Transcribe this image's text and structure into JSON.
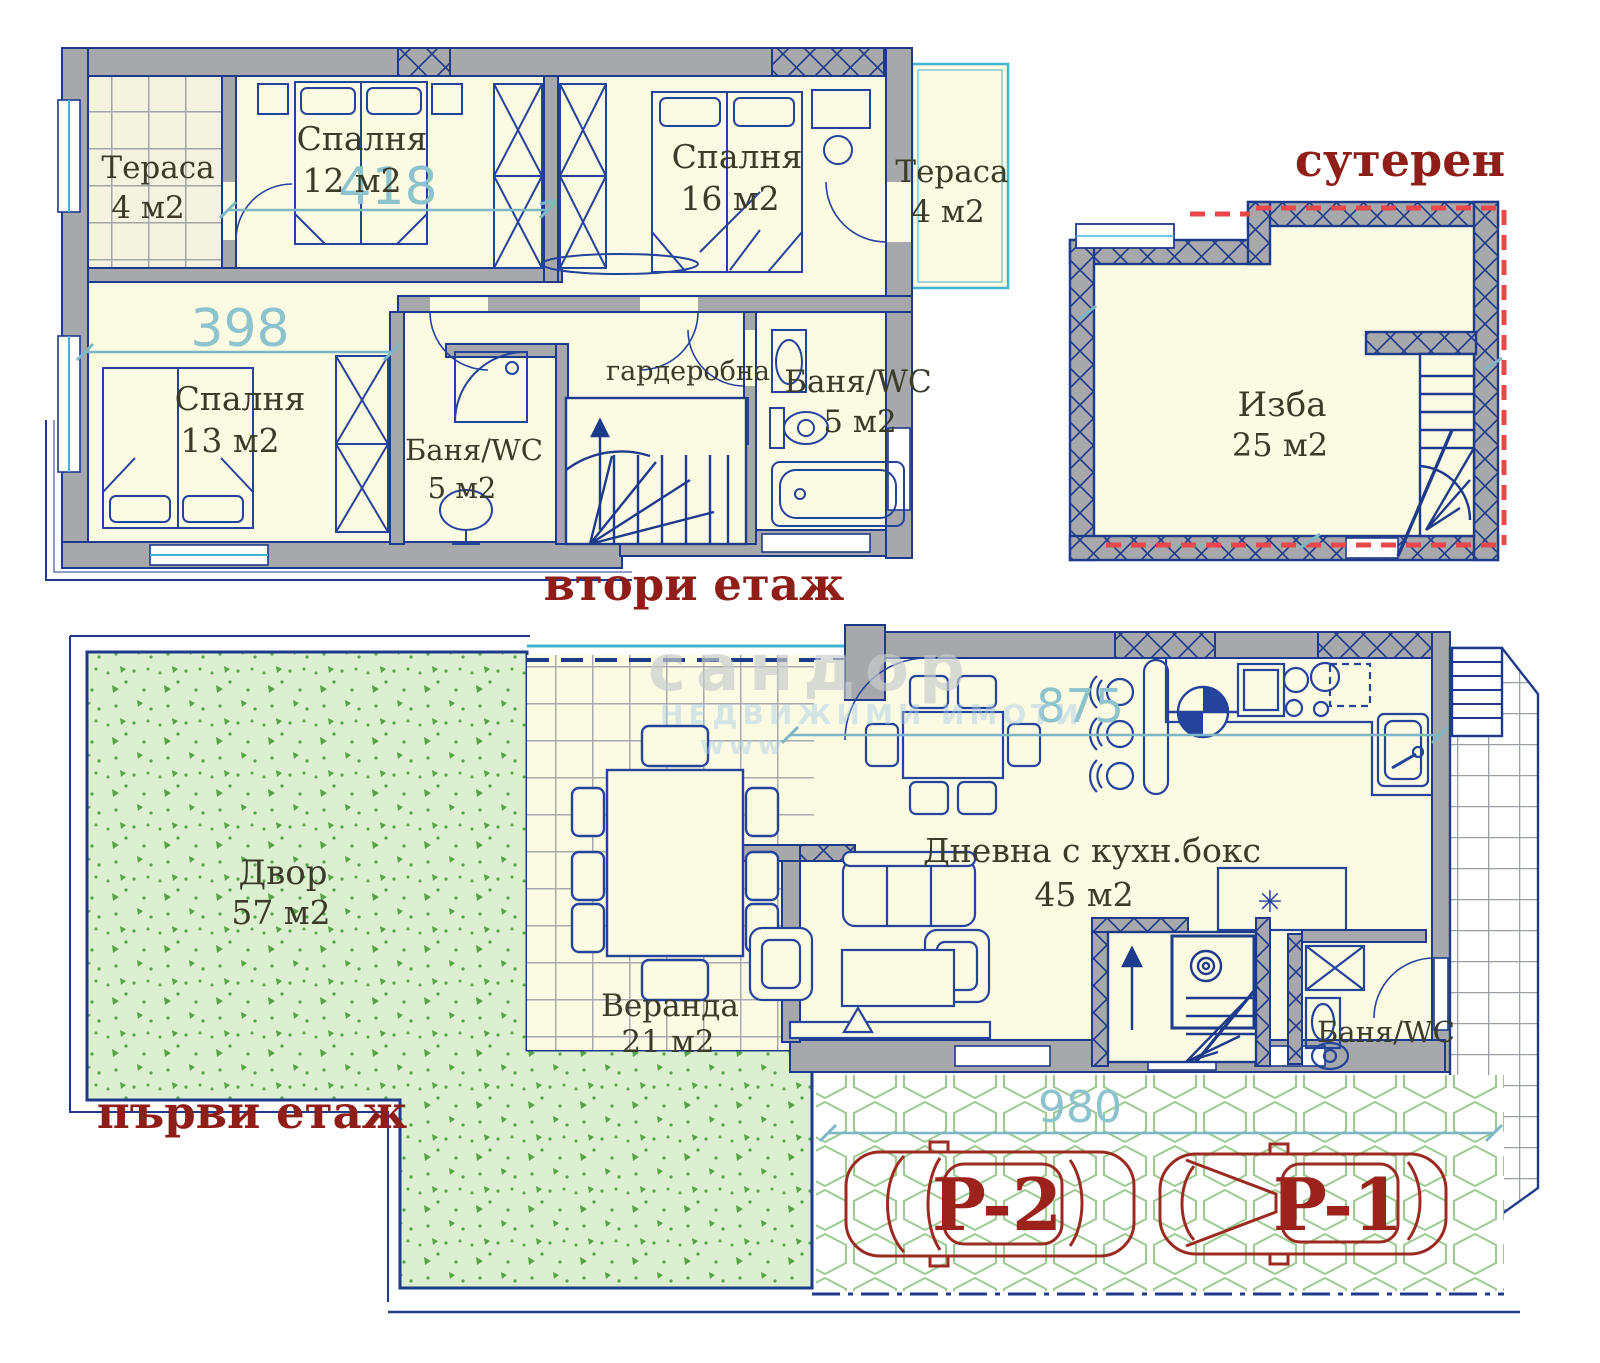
{
  "drawing_type": "house floor plan (3 levels) with yard and parking",
  "floors": {
    "second_floor": {
      "title": "втори етаж",
      "rooms": [
        {
          "name": "Тераса",
          "area": "4 м2"
        },
        {
          "name": "Спалня",
          "area": "12 м2"
        },
        {
          "name": "Спалня",
          "area": "16 м2"
        },
        {
          "name": "Тераса",
          "area": "4 м2"
        },
        {
          "name": "Спалня",
          "area": "13 м2"
        },
        {
          "name": "Баня/WC",
          "area": "5 м2"
        },
        {
          "name": "гардеробна",
          "area": ""
        },
        {
          "name": "Баня/WC",
          "area": "5 м2"
        }
      ],
      "dimensions": {
        "bedroom12_width": "418",
        "bedroom13_width": "398"
      }
    },
    "basement": {
      "title": "сутерен",
      "rooms": [
        {
          "name": "Изба",
          "area": "25 м2"
        }
      ]
    },
    "first_floor": {
      "title": "първи етаж",
      "rooms": [
        {
          "name": "Двор",
          "area": "57 м2"
        },
        {
          "name": "Веранда",
          "area": "21 м2"
        },
        {
          "name": "Дневна с кухн.бокс",
          "area": "45 м2"
        },
        {
          "name": "Баня/WC",
          "area": ""
        }
      ],
      "dimensions": {
        "living_width": "875",
        "parking_width": "980"
      }
    }
  },
  "parking": {
    "spots": [
      "P-2",
      "P-1"
    ]
  },
  "watermark": {
    "line1": "сандор",
    "line2": "НЕДВИЖИМИ ИМОТИ",
    "line3": "www"
  },
  "colors": {
    "wall_outline_navy": "#1e3a8a",
    "wall_fill_gray": "#a6a8ab",
    "room_fill_cream": "#fbfae3",
    "dimension_teal": "#7db6c4",
    "title_dark_red": "#8f1d18",
    "car_dark_red": "#9b2b22",
    "yard_green": "#dcefd0",
    "paving_hex_green": "#9ccb8f",
    "basement_dashed_red": "#e8474b"
  }
}
